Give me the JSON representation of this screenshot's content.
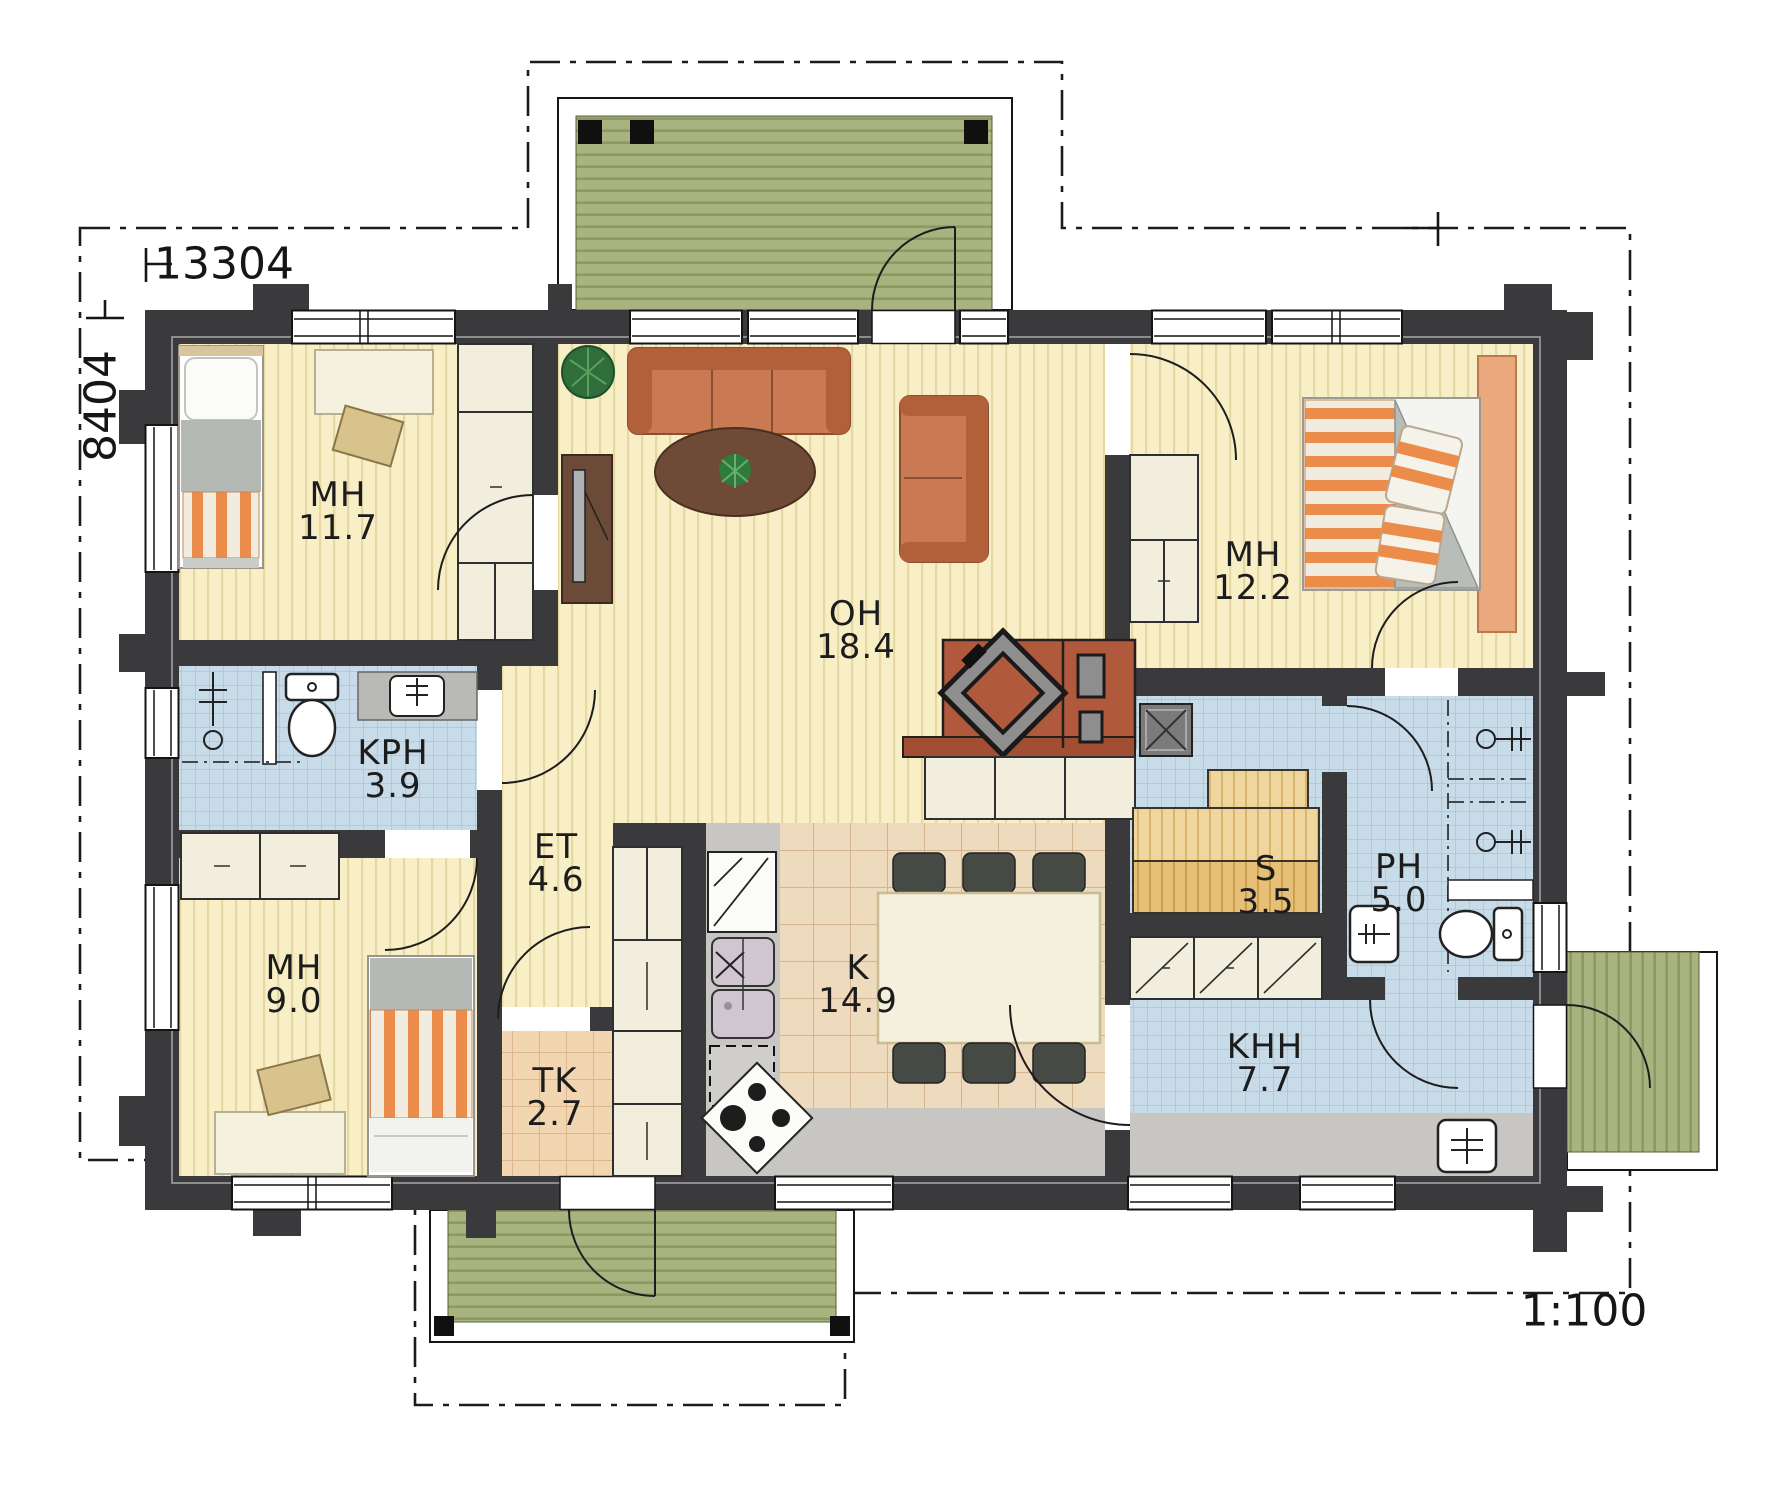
{
  "drawing": {
    "type": "floor-plan",
    "scale_label": "1:100",
    "dimensions": {
      "width_mm": "13304",
      "height_mm": "8404"
    }
  },
  "rooms": [
    {
      "id": "mh-11-7",
      "name": "MH",
      "area": "11.7"
    },
    {
      "id": "oh-18-4",
      "name": "OH",
      "area": "18.4"
    },
    {
      "id": "mh-12-2",
      "name": "MH",
      "area": "12.2"
    },
    {
      "id": "kph-3-9",
      "name": "KPH",
      "area": "3.9"
    },
    {
      "id": "et-4-6",
      "name": "ET",
      "area": "4.6"
    },
    {
      "id": "mh-9-0",
      "name": "MH",
      "area": "9.0"
    },
    {
      "id": "tk-2-7",
      "name": "TK",
      "area": "2.7"
    },
    {
      "id": "k-14-9",
      "name": "K",
      "area": "14.9"
    },
    {
      "id": "s-3-5",
      "name": "S",
      "area": "3.5"
    },
    {
      "id": "ph-5-0",
      "name": "PH",
      "area": "5.0"
    },
    {
      "id": "khh-7-7",
      "name": "KHH",
      "area": "7.7"
    }
  ],
  "colors": {
    "wall": "#3a3a3c",
    "floor_yellow": "#f8efc6",
    "tile_blue": "#c7dbe9",
    "tile_tan": "#eedabd",
    "deck_green": "#a9b37f",
    "sauna_wood": "#e6c077",
    "fireplace_brick": "#b0593c",
    "sofa_orange": "#c97a52"
  }
}
